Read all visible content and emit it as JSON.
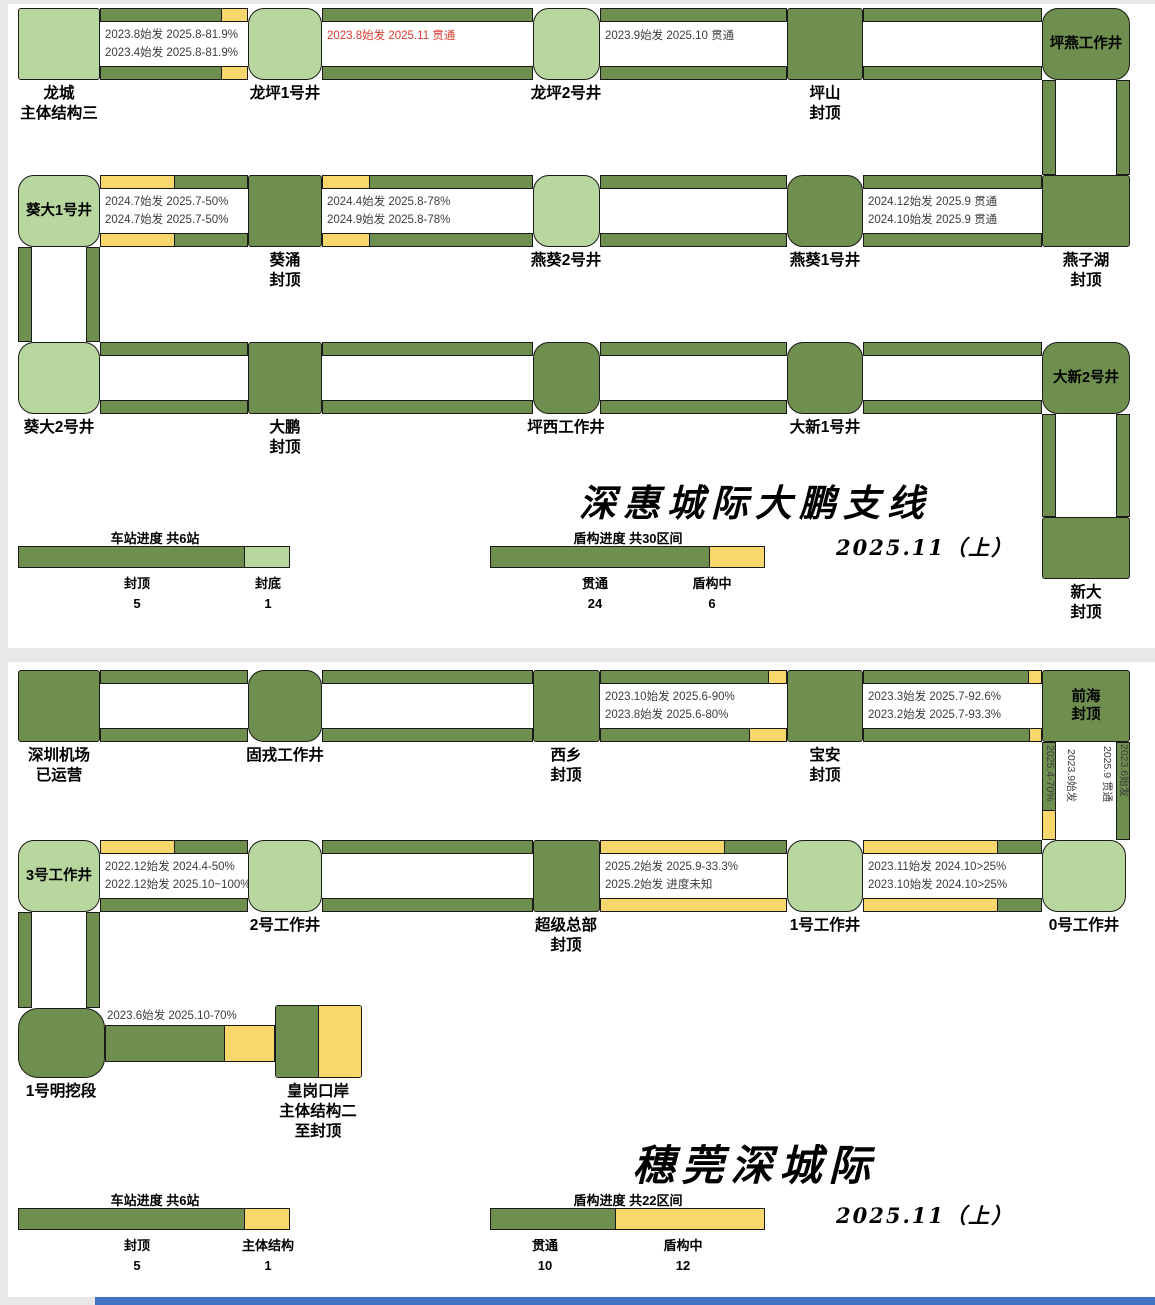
{
  "colors": {
    "dark_green": "#6E8F4E",
    "light_green": "#B8D79E",
    "yellow": "#F8D76D",
    "red_text": "#D93A2F",
    "bottom_bar_blue": "#4472C4"
  },
  "s1": {
    "title": "深惠城际大鹏支线",
    "date": "2025.11（上）",
    "stations": {
      "longcheng": "龙城\n主体结构三",
      "longping1": "龙坪1号井",
      "longping2": "龙坪2号井",
      "pingshan": "坪山\n封顶",
      "pingyan": "坪燕工作井",
      "kuida1": "葵大1号井",
      "kuichong": "葵涌\n封顶",
      "yankui2": "燕葵2号井",
      "yankui1": "燕葵1号井",
      "yanzihu": "燕子湖\n封顶",
      "kuida2": "葵大2号井",
      "dapeng": "大鹏\n封顶",
      "pingxi": "坪西工作井",
      "daxin1": "大新1号井",
      "daxin2": "大新2号井",
      "xinda": "新大\n封顶"
    },
    "tunnels": {
      "r1t1a": "2023.8始发 2025.8-81.9%",
      "r1t1b": "2023.4始发 2025.8-81.9%",
      "r1t2": "2023.8始发 2025.11 贯通",
      "r1t3": "2023.9始发 2025.10 贯通",
      "r2t1a": "2024.7始发 2025.7-50%",
      "r2t1b": "2024.7始发 2025.7-50%",
      "r2t2a": "2024.4始发 2025.8-78%",
      "r2t2b": "2024.9始发 2025.8-78%",
      "r2t4a": "2024.12始发 2025.9 贯通",
      "r2t4b": "2024.10始发 2025.9 贯通"
    },
    "station_legend": {
      "title": "车站进度 共6站",
      "label1": "封顶\n5",
      "label2": "封底\n1"
    },
    "shield_legend": {
      "title": "盾构进度 共30区间",
      "label1": "贯通\n24",
      "label2": "盾构中\n6"
    }
  },
  "s2": {
    "title": "穗莞深城际",
    "date": "2025.11（上）",
    "stations": {
      "jichang": "深圳机场\n已运营",
      "gurong": "固戎工作井",
      "xixiang": "西乡\n封顶",
      "baoan": "宝安\n封顶",
      "qianhai": "前海\n封顶",
      "w3": "3号工作井",
      "w2": "2号工作井",
      "chaoji": "超级总部\n封顶",
      "w1": "1号工作井",
      "w0": "0号工作井",
      "mingwa": "1号明挖段",
      "huanggang": "皇岗口岸\n主体结构二\n至封顶"
    },
    "tunnels": {
      "r1t3a": "2023.10始发 2025.6-90%",
      "r1t3b": "2023.8始发 2025.6-80%",
      "r1t4a": "2023.3始发 2025.7-92.6%",
      "r1t4b": "2023.2始发 2025.7-93.3%",
      "v_left_bar": "2025.4-70%",
      "v_left_label": "2023.9始发",
      "v_right_label": "2025.9 贯通",
      "v_right_bar": "2023.6始发",
      "r2t1a": "2022.12始发 2024.4-50%",
      "r2t1b": "2022.12始发 2025.10~100%",
      "r2t3a": "2025.2始发 2025.9-33.3%",
      "r2t3b": "2025.2始发 进度未知",
      "r2t4a": "2023.11始发 2024.10>25%",
      "r2t4b": "2023.10始发 2024.10>25%",
      "r3": "2023.6始发 2025.10-70%"
    },
    "station_legend": {
      "title": "车站进度 共6站",
      "label1": "封顶\n5",
      "label2": "主体结构\n1"
    },
    "shield_legend": {
      "title": "盾构进度 共22区间",
      "label1": "贯通\n10",
      "label2": "盾构中\n12"
    }
  }
}
